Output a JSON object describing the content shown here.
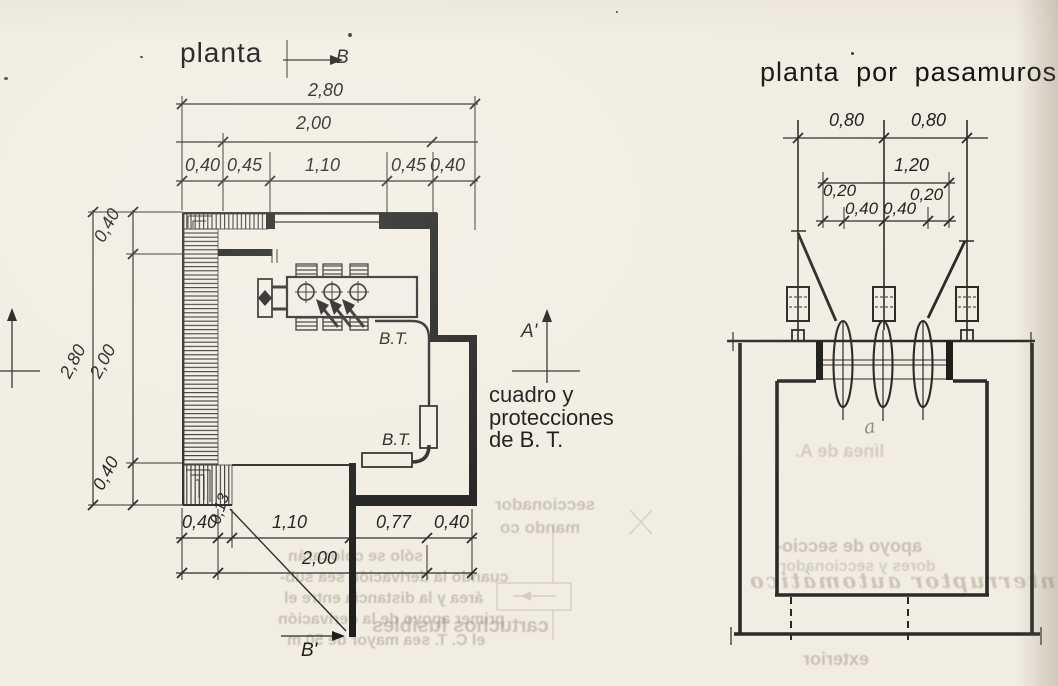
{
  "paper": {
    "background": "#f2ede2",
    "ink": "#2a2a28",
    "edge_shade": "#7d735f"
  },
  "left_plan": {
    "title": "planta",
    "section_markers": {
      "b_top": "B",
      "b_bottom": "B'",
      "a_right": "A'"
    },
    "dims_top": {
      "total": "2,80",
      "inner": "2,00",
      "segments": [
        "0,40",
        "0,45",
        "1,10",
        "0,45",
        "0,40"
      ]
    },
    "dims_left": {
      "total": "2,80",
      "segments": [
        "0,40",
        "2,00",
        "0,40"
      ]
    },
    "dims_bottom": {
      "segments": [
        "0,40",
        "0,13",
        "1,10",
        "0,77",
        "0,40"
      ],
      "inner": "2,00"
    },
    "bt_upper": "B.T.",
    "bt_lower": "B.T.",
    "annotation_lines": [
      "cuadro y",
      "protecciones",
      "de B. T."
    ]
  },
  "right_plan": {
    "title": "planta por pasamuros",
    "dims": {
      "top_left": "0,80",
      "top_right": "0,80",
      "total": "1,20",
      "edge_left": "0,20",
      "edge_right": "0,20",
      "mid_left": "0,40",
      "mid_right": "0,40"
    }
  },
  "ghost": {
    "para_lines": [
      "sólo se colocarán",
      "cuando la derivación sea sub-",
      "área y la distancia entre el",
      "primer apoyo de la derivación",
      "el C. T. sea mayor de 50 m"
    ],
    "seccionador": "seccionador",
    "mando": "mando co",
    "fusibles": "cartuchos fusibles",
    "linea": "línea de A.",
    "apoyo": "apoyo de seccio-",
    "nadores": "dores y seccionador",
    "interruptor": "interruptor automático",
    "exterior": "exterior"
  },
  "pencil_note": "a"
}
